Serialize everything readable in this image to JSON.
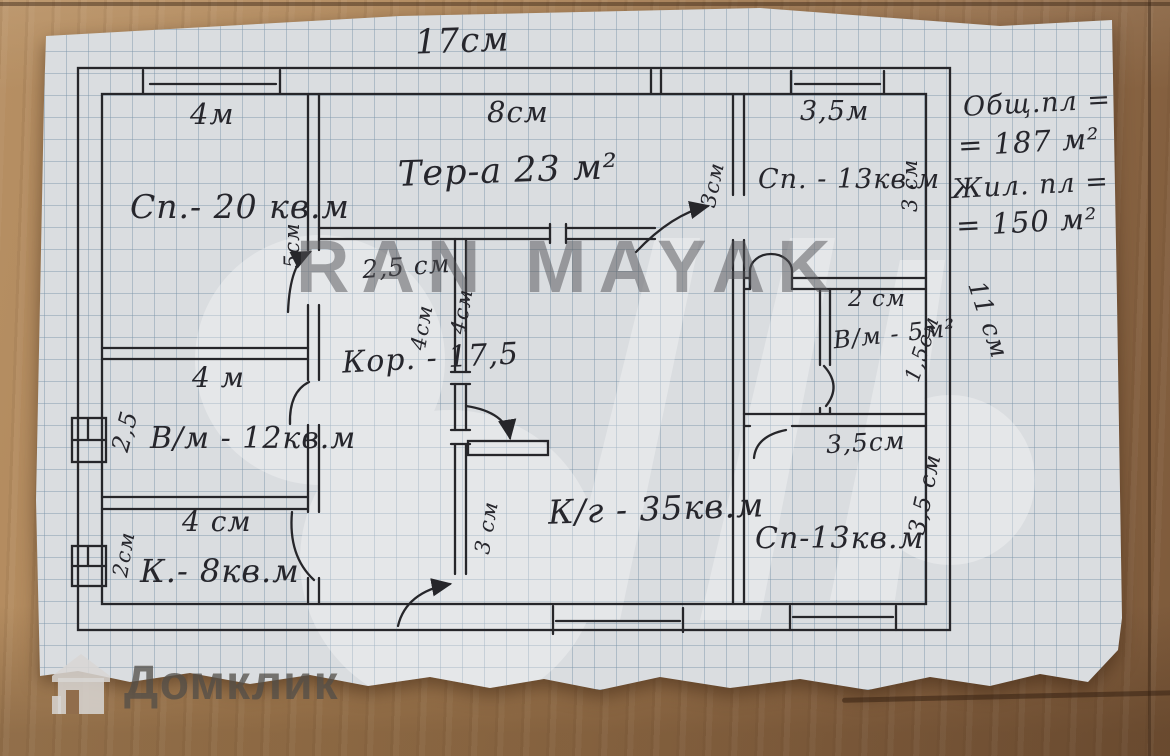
{
  "plan": {
    "rooms": {
      "sp20": "Сп.- 20 кв.м",
      "terrace": "Тер-а  23 м²",
      "sp13_top": "Сп. - 13кв.м",
      "vm12": "В/м - 12кв.м",
      "corridor": "Кор. - 17,5",
      "k8": "К.- 8кв.м",
      "kg35": "К/г - 35кв.м",
      "vm5": "В/м - 5м²",
      "sp13_bottom": "Сп-13кв.м"
    },
    "dims": {
      "total_width": "17см",
      "w4m_top": "4м",
      "w5cm_vert": "5см",
      "w8cm": "8см",
      "w3cm_left": "3см",
      "w35m_top": "3,5м",
      "w3cm_right": "3 см",
      "w25cm_corridor": "2,5 см",
      "w4cm_a": "4см",
      "w4cm_b": "4см",
      "w4m_mid": "4 м",
      "w25_left": "2,5",
      "w4cm_bottom": "4 см",
      "w2cm_left": "2см",
      "w3cm_kitchen": "3 см",
      "w2cm_vm5": "2 см",
      "w15cm_right": "1,5см",
      "w35cm_mid": "3,5см",
      "w35cm_right": "3,5 см",
      "w11cm_edge": "11 см"
    }
  },
  "summary": {
    "total_label": "Общ.пл =",
    "total_value": "= 187 м²",
    "living_label": "Жил. пл =",
    "living_value": "= 150 м²"
  },
  "watermarks": {
    "agency": "RAN MAYAK",
    "portal": "Домклик"
  }
}
